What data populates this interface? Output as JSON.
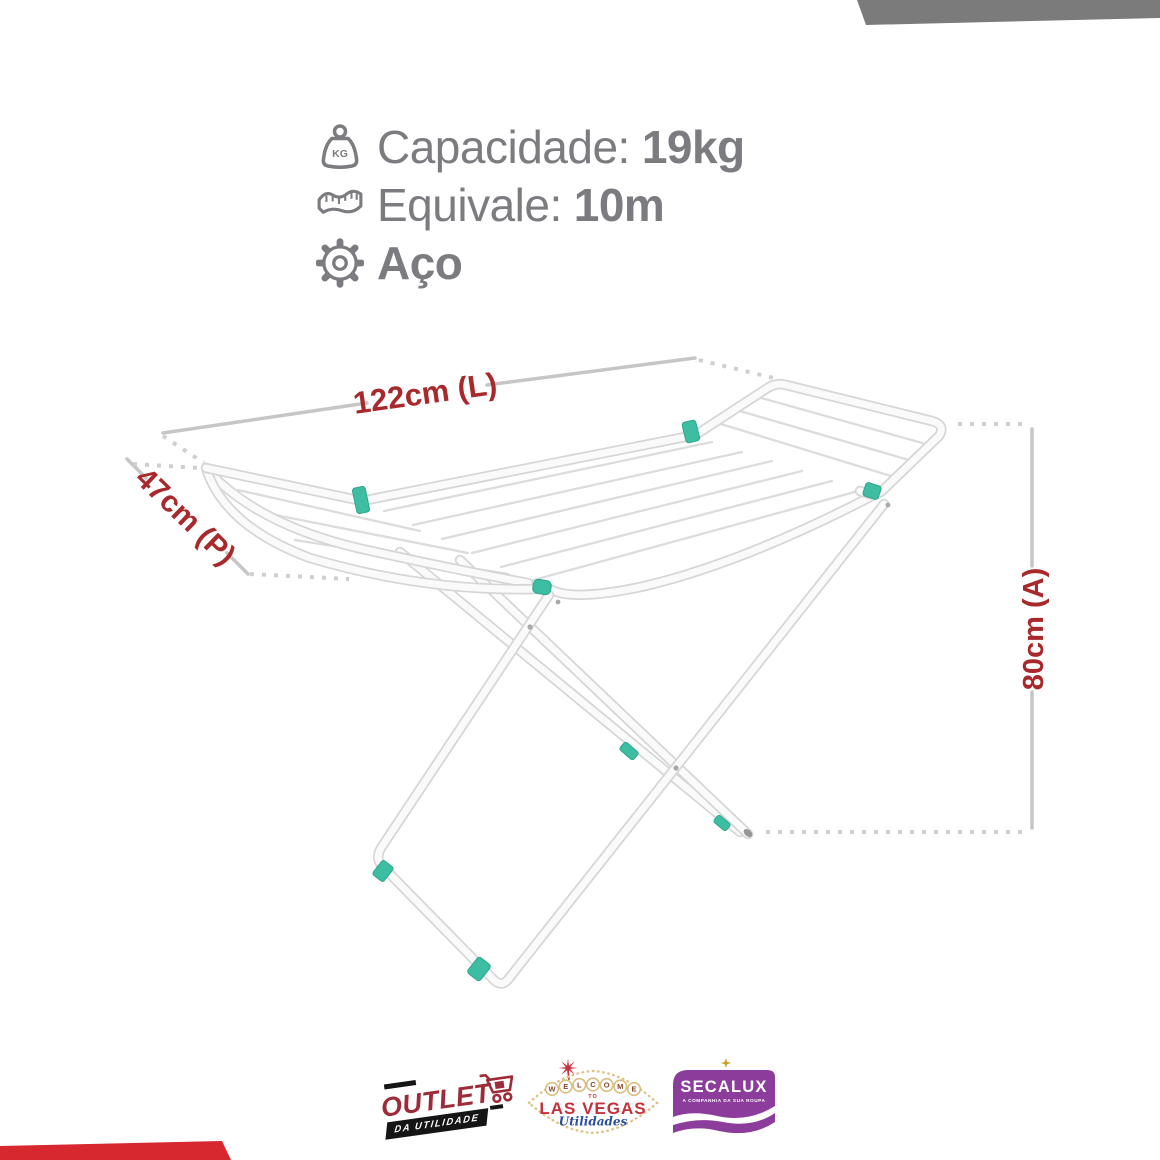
{
  "product_specs": {
    "capacity": {
      "icon": "weight-kg-icon",
      "icon_text": "KG",
      "label": "Capacidade:",
      "value": "19kg"
    },
    "equivalent": {
      "icon": "tape-measure-icon",
      "label": "Equivale:",
      "value": "10m"
    },
    "material": {
      "icon": "gear-icon",
      "value": "Aço"
    }
  },
  "dimensions": {
    "length": "122cm (L)",
    "depth": "47cm (P)",
    "height": "80cm (A)"
  },
  "footer_logos": {
    "outlet": {
      "name": "OUTLET",
      "subtitle": "DA UTILIDADE",
      "icon": "shopping-cart-icon"
    },
    "las_vegas": {
      "welcome_letters": [
        "W",
        "E",
        "L",
        "C",
        "O",
        "M",
        "E"
      ],
      "to": "TO",
      "name": "LAS VEGAS",
      "script": "Utilidades",
      "icon": "star-burst-icon"
    },
    "secalux": {
      "name": "SECALUX",
      "tagline": "A COMPANHIA DA SUA ROUPA",
      "icon": "sparkle-icon"
    }
  },
  "colors": {
    "spec_text_gray": "#7c7c80",
    "dimension_red": "#A8292C",
    "clip_teal": "#3DBEA3",
    "corner_band_gray": "#7b7b7b",
    "corner_band_red": "#D7282F",
    "outlet_red": "#9E2B38",
    "vegas_red": "#C5303C",
    "vegas_gold": "#DFC385",
    "vegas_blue": "#2B4FA0",
    "secalux_purple": "#8C3D9C"
  }
}
